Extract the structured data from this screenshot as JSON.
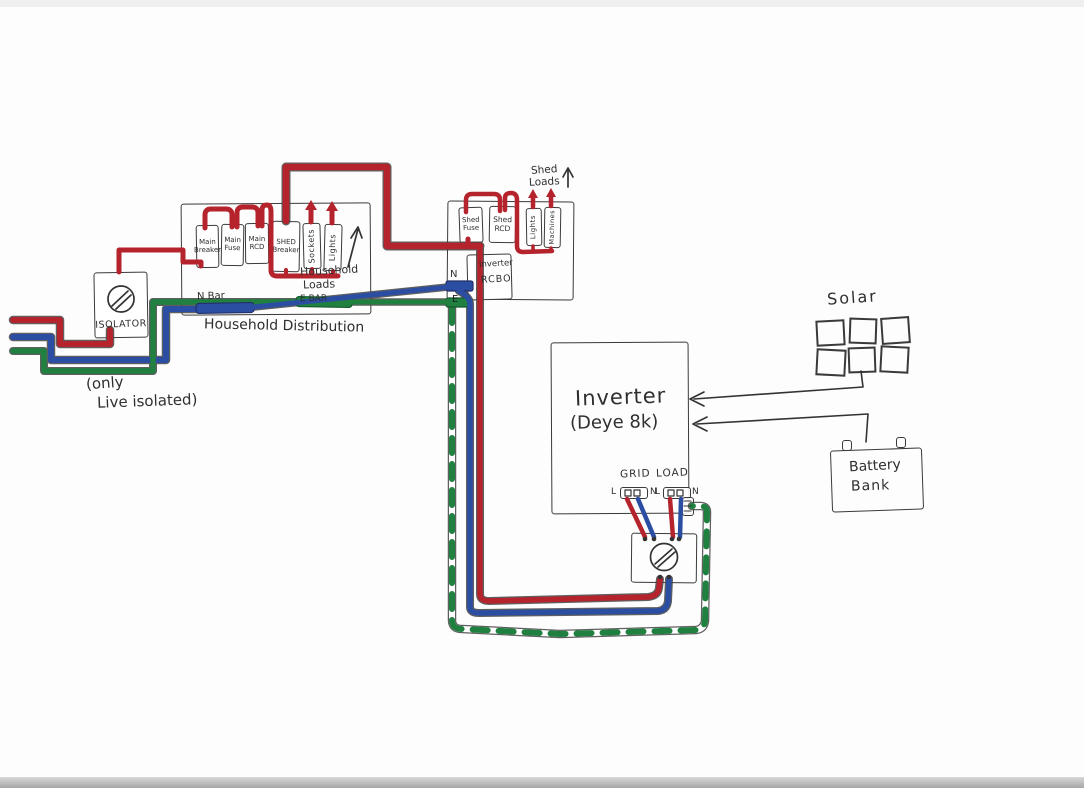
{
  "colors": {
    "live": "#b5232d",
    "neutral": "#2b4ea3",
    "earth": "#1f8040",
    "ink": "#333333"
  },
  "isolator": {
    "label": "ISOLATOR",
    "note_line1": "(only",
    "note_line2": "Live isolated)"
  },
  "household": {
    "title": "Household Distribution",
    "breakers": [
      "Main Breaker",
      "Main Fuse",
      "Main RCD",
      "SHED Breaker",
      "Sockets",
      "Lights"
    ],
    "loads_line1": "Household",
    "loads_line2": "Loads",
    "n_bar": "N Bar",
    "e_bar": "E BAR"
  },
  "shed": {
    "loads_line1": "Shed",
    "loads_line2": "Loads",
    "breakers": [
      "Shed Fuse",
      "Shed RCD",
      "Lights",
      "Machines"
    ],
    "rcbo_line1": "Inverter",
    "rcbo_line2": "RCBO",
    "n_bar": "N",
    "e_bar": "E"
  },
  "inverter": {
    "name": "Inverter",
    "model": "(Deye 8k)",
    "grid_label": "GRID",
    "load_label": "LOAD",
    "terminal_l": "L",
    "terminal_n": "N"
  },
  "solar": {
    "label": "Solar",
    "panel_count": 6
  },
  "battery": {
    "line1": "Battery",
    "line2": "Bank"
  }
}
